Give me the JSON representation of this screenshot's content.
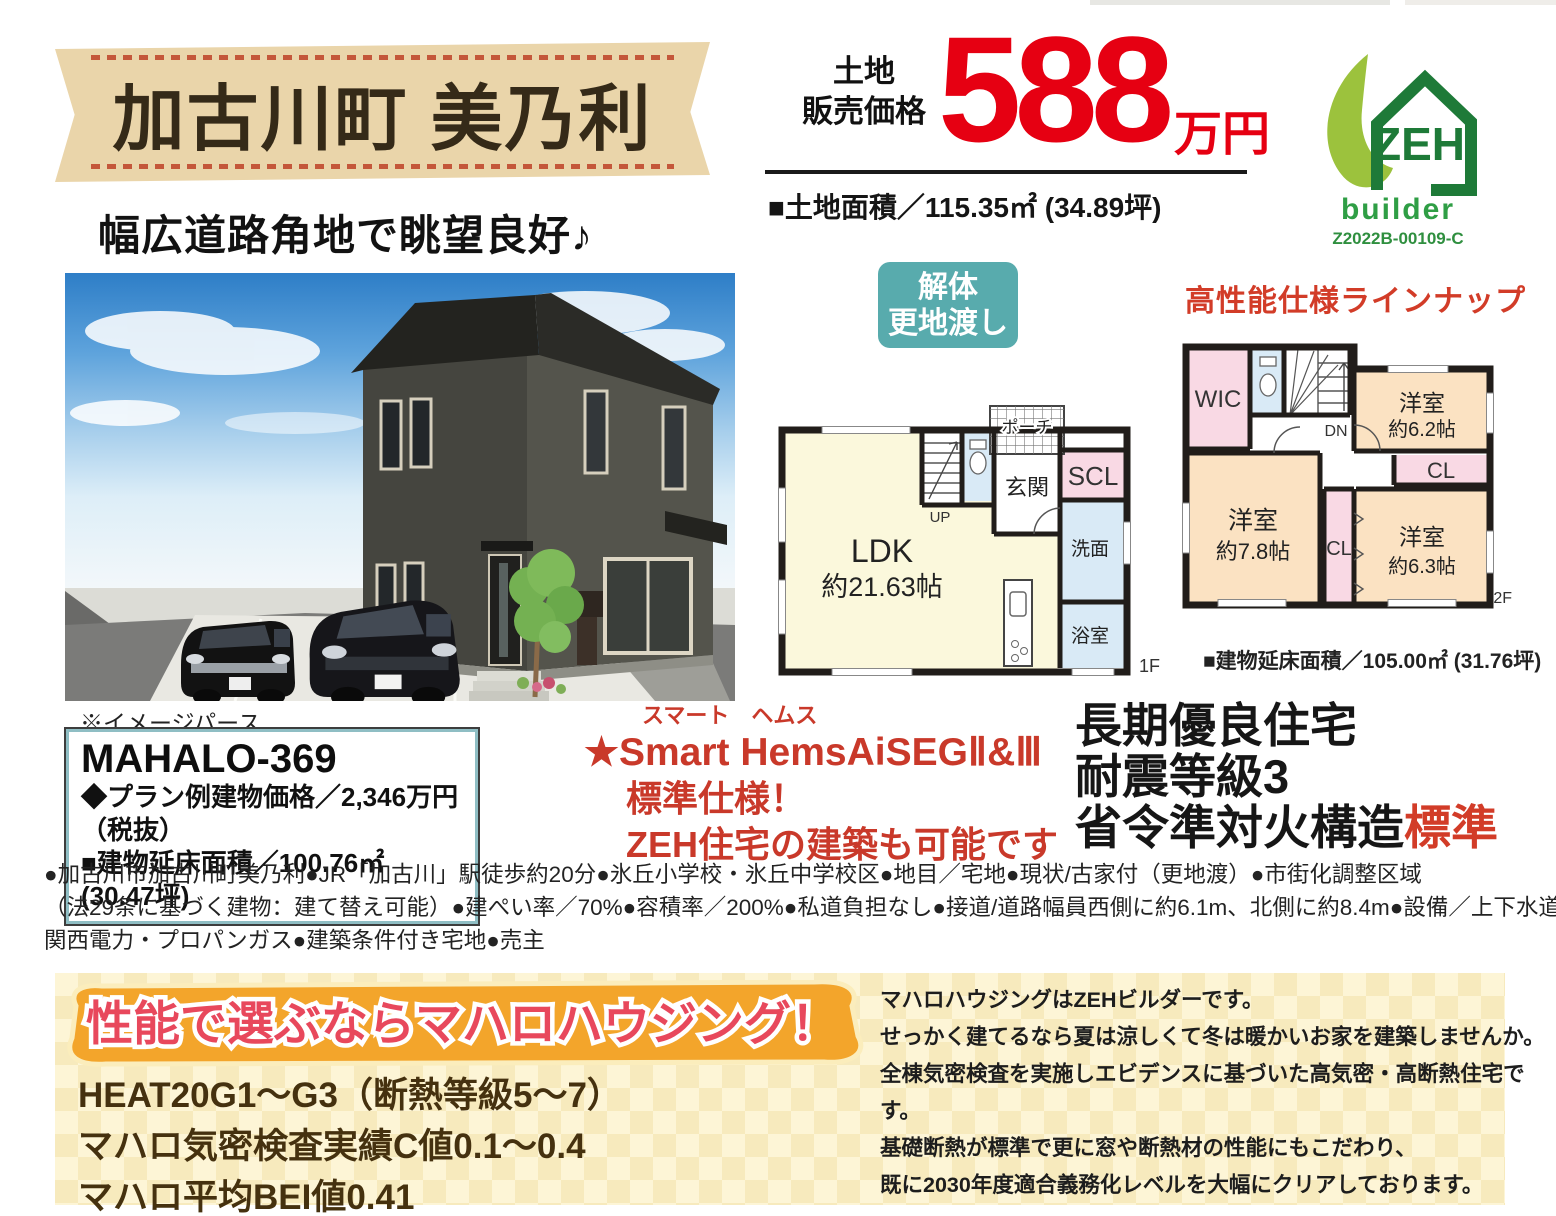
{
  "top": {
    "location": "加古川町 美乃利",
    "catchphrase": "幅広道路角地で眺望良好♪",
    "price_label1": "土地",
    "price_label2": "販売価格",
    "price_value": "588",
    "price_unit": "万円",
    "land_area": "■土地面積／115.35㎡ (34.89坪)"
  },
  "zeh": {
    "name": "ZEH",
    "builder": "builder",
    "code": "Z2022B-00109-C"
  },
  "render": {
    "note": "※イメージパース"
  },
  "plan_box": {
    "name": "MAHALO-369",
    "price": "◆プラン例建物価格／2,346万円（税抜）",
    "area": "■建物延床面積／100.76㎡ (30.47坪)"
  },
  "badge": {
    "line1": "解体",
    "line2": "更地渡し"
  },
  "lineup": {
    "title": "高性能仕様ラインナップ"
  },
  "fp1": {
    "ldk": "LDK",
    "ldk_size": "約21.63帖",
    "up": "UP",
    "porch": "ポーチ",
    "genkan": "玄関",
    "scl": "SCL",
    "senmen": "洗面",
    "bath": "浴室",
    "label": "1F"
  },
  "fp2": {
    "wic": "WIC",
    "dn": "DN",
    "room1": "洋室",
    "room1_size": "約6.2帖",
    "cl1": "CL",
    "room2": "洋室",
    "room2_size": "約7.8帖",
    "cl2": "CL",
    "room3": "洋室",
    "room3_size": "約6.3帖",
    "label": "2F"
  },
  "building_area": {
    "text": "■建物延床面積／105.00㎡ (31.76坪)"
  },
  "hems": {
    "furigana": "スマート　ヘムス",
    "line1": "★Smart HemsAiSEGⅡ&Ⅲ",
    "line2": "標準仕様！",
    "line3": "ZEH住宅の建築も可能です"
  },
  "cert": {
    "line1": "長期優良住宅",
    "line2": "耐震等級3",
    "line3_black": "省令準対火構造",
    "line3_red": "標準"
  },
  "details": {
    "line1": "●加古川市加古川町美乃利●JR「加古川」駅徒歩約20分●氷丘小学校・氷丘中学校区●地目／宅地●現状/古家付（更地渡）●市街化調整区域",
    "line2": "（法29条に基づく建物：建て替え可能）●建ぺい率／70%●容積率／200%●私道負担なし●接道/道路幅員西側に約6.1m、北側に約8.4m●設備／上下水道・",
    "line3": "関西電力・プロパンガス●建築条件付き宅地●売主"
  },
  "footer": {
    "banner": "性能で選ぶならマハロハウジング！",
    "spec1": "HEAT20G1～G3（断熱等級5～7）",
    "spec2": "マハロ気密検査実績C値0.1～0.4",
    "spec3": "マハロ平均BEI値0.41",
    "desc1": "マハロハウジングはZEHビルダーです。",
    "desc2": "せっかく建てるなら夏は涼しくて冬は暖かいお家を建築しませんか。",
    "desc3": "全棟気密検査を実施しエビデンスに基づいた高気密・高断熱住宅です。",
    "desc4": "基礎断熱が標準で更に窓や断熱材の性能にもこだわり、",
    "desc5": "既に2030年度適合義務化レベルを大幅にクリアしております。"
  }
}
